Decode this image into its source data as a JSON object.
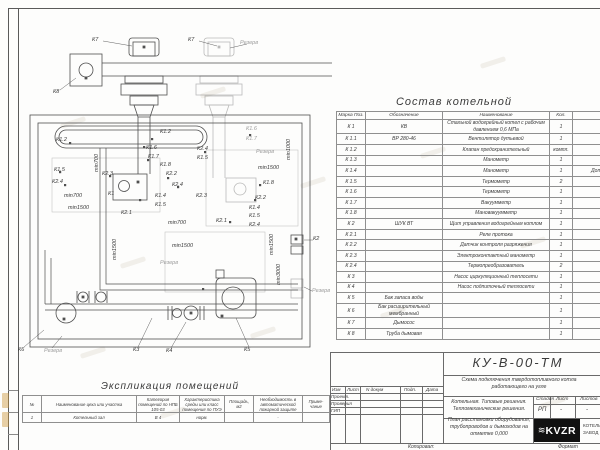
{
  "colors": {
    "line": "#4f4f4f",
    "faded_line": "#b3b3b3",
    "table_line": "#8f8f8f",
    "text": "#3a3a3a",
    "logo_bg": "#111111",
    "logo_text": "#ffffff"
  },
  "diagram": {
    "labels": [
      {
        "t": "К7",
        "x": 92,
        "y": 38
      },
      {
        "t": "К7",
        "x": 188,
        "y": 38
      },
      {
        "t": "Резерв",
        "x": 240,
        "y": 41,
        "f": 1
      },
      {
        "t": "К8",
        "x": 53,
        "y": 90
      },
      {
        "t": "К1.2",
        "x": 56,
        "y": 138
      },
      {
        "t": "К1.2",
        "x": 160,
        "y": 130
      },
      {
        "t": "min700",
        "x": 95,
        "y": 172,
        "r": 1
      },
      {
        "t": "К1.6",
        "x": 146,
        "y": 146
      },
      {
        "t": "К1.7",
        "x": 148,
        "y": 155
      },
      {
        "t": "К1.5",
        "x": 54,
        "y": 168
      },
      {
        "t": "К2.4",
        "x": 52,
        "y": 180
      },
      {
        "t": "К2.3",
        "x": 102,
        "y": 172
      },
      {
        "t": "К1.8",
        "x": 160,
        "y": 163
      },
      {
        "t": "К2.2",
        "x": 166,
        "y": 172
      },
      {
        "t": "К2.4",
        "x": 172,
        "y": 183
      },
      {
        "t": "min700",
        "x": 64,
        "y": 194
      },
      {
        "t": "К1",
        "x": 108,
        "y": 192
      },
      {
        "t": "К1.4",
        "x": 155,
        "y": 194
      },
      {
        "t": "К1.5",
        "x": 155,
        "y": 203
      },
      {
        "t": "min1500",
        "x": 68,
        "y": 206
      },
      {
        "t": "К2.1",
        "x": 121,
        "y": 211
      },
      {
        "t": "К1.6",
        "x": 246,
        "y": 127,
        "f": 1
      },
      {
        "t": "К1.7",
        "x": 246,
        "y": 137,
        "f": 1
      },
      {
        "t": "min1000",
        "x": 287,
        "y": 160,
        "r": 1
      },
      {
        "t": "К2.4",
        "x": 197,
        "y": 147
      },
      {
        "t": "К1.5",
        "x": 197,
        "y": 156
      },
      {
        "t": "Резерв",
        "x": 256,
        "y": 150,
        "f": 1
      },
      {
        "t": "min1500",
        "x": 258,
        "y": 166
      },
      {
        "t": "К1.8",
        "x": 263,
        "y": 181
      },
      {
        "t": "К2.3",
        "x": 196,
        "y": 194
      },
      {
        "t": "К2.2",
        "x": 255,
        "y": 196
      },
      {
        "t": "К1.4",
        "x": 249,
        "y": 206
      },
      {
        "t": "К1.5",
        "x": 249,
        "y": 214
      },
      {
        "t": "К2.1",
        "x": 216,
        "y": 219
      },
      {
        "t": "К2.4",
        "x": 249,
        "y": 223
      },
      {
        "t": "min700",
        "x": 168,
        "y": 221
      },
      {
        "t": "min1500",
        "x": 113,
        "y": 260,
        "r": 1
      },
      {
        "t": "min1500",
        "x": 172,
        "y": 244
      },
      {
        "t": "min1500",
        "x": 270,
        "y": 255,
        "r": 1
      },
      {
        "t": "min3000",
        "x": 277,
        "y": 285,
        "r": 1
      },
      {
        "t": "Резерв",
        "x": 160,
        "y": 261,
        "f": 1
      },
      {
        "t": "К2",
        "x": 313,
        "y": 237
      },
      {
        "t": "Резерв",
        "x": 312,
        "y": 289,
        "f": 1
      },
      {
        "t": "К6",
        "x": 18,
        "y": 348
      },
      {
        "t": "Резерв",
        "x": 44,
        "y": 349,
        "f": 1
      },
      {
        "t": "К3",
        "x": 133,
        "y": 348
      },
      {
        "t": "К4",
        "x": 166,
        "y": 349
      },
      {
        "t": "К5",
        "x": 244,
        "y": 348
      }
    ]
  },
  "sostav": {
    "title": "Состав котельной",
    "headers": [
      "Марка Поз.",
      "Обозначение",
      "Наименование",
      "Кол.",
      "Примечание"
    ],
    "rows": [
      [
        "К 1",
        "КВ",
        "Стальной водогрейный котел с рабочим давлением 0,6 МПа",
        "1",
        ""
      ],
      [
        "К 1.1",
        "ВР 280-46",
        "Вентилятор дутьевой",
        "1",
        ""
      ],
      [
        "К 1.2",
        "",
        "Клапан предохранительный",
        "компл.",
        ""
      ],
      [
        "К 1.3",
        "",
        "Манометр",
        "1",
        ""
      ],
      [
        "К 1.4",
        "",
        "Манометр",
        "1",
        "Допускается зам. поз. К 2.3"
      ],
      [
        "К 1.5",
        "",
        "Термометр",
        "2",
        ""
      ],
      [
        "К 1.6",
        "",
        "Термометр",
        "1",
        "Постав. по согла"
      ],
      [
        "К 1.7",
        "",
        "Вакуумметр",
        "1",
        "Постав. по согла"
      ],
      [
        "К 1.8",
        "",
        "Мановакуумметр",
        "1",
        "Постав. по согла"
      ],
      [
        "К 2",
        "ШУК ВТ",
        "Щит управления водогрейным котлом",
        "1",
        "Постав. по согла"
      ],
      [
        "К 2.1",
        "",
        "Реле протока",
        "1",
        "Постав. с ШУК"
      ],
      [
        "К 2.2",
        "",
        "Датчик контроля разряжения",
        "1",
        "Постав. с ШУК"
      ],
      [
        "К 2.3",
        "",
        "Электроконтактный манометр",
        "1",
        "Постав. с ШУК"
      ],
      [
        "К 2.4",
        "",
        "Термопреобразователь",
        "2",
        "Постав. с ШУК"
      ],
      [
        "К 3",
        "",
        "Насос циркуляционный теплосети",
        "1",
        "Постав. по согла"
      ],
      [
        "К 4",
        "",
        "Насос подпиточный теплосети",
        "1",
        "Постав. по согла"
      ],
      [
        "К 5",
        "Бак запаса воды",
        "",
        "1",
        "Постав. по согла"
      ],
      [
        "К 6",
        "Бак расширительный мембранный",
        "",
        "1",
        "Постав. по согла"
      ],
      [
        "К 7",
        "Дымосос",
        "",
        "1",
        "Постав. по согла"
      ],
      [
        "К 8",
        "Труба дымовая",
        "",
        "1",
        "Постав. по согла"
      ]
    ]
  },
  "explication": {
    "title": "Экспликация помещений",
    "headers": [
      "№",
      "Наименование цеха или участка",
      "Категория помещений по НПБ 105-03",
      "Характеристика среды или класс помещения по ПУЭ",
      "Площадь, м2",
      "Необходимость в автоматической пожарной защите",
      "Приме- чание"
    ],
    "rows": [
      [
        "1",
        "Котельный зал",
        "В 4",
        "норм.",
        "",
        "-",
        ""
      ]
    ]
  },
  "titleblock": {
    "doc_number": "КУ-В-00-ТМ",
    "scheme_title": "Схема подключения твердотопливного котла работающего на угле",
    "project_name": "Котельная. Типовые решения. Тепломеханические решения.",
    "sheet_name": "План расстановки оборудования, трубопроводов и дымоходов на отметке 0,000",
    "stage_label": "Стадия",
    "stage_value": "РП",
    "sheet_label": "Лист",
    "sheet_value": "-",
    "sheets_label": "Листов",
    "sheets_value": "-",
    "rev_headers": [
      "Изм",
      "Лист",
      "N докум",
      "Подп.",
      "Дата"
    ],
    "sig_rows": [
      "Проект.",
      "Проверил",
      "ГИП"
    ],
    "copied_label": "Копировал:",
    "format_label": "Формат",
    "logo_text": "KVZR",
    "logo_side1": "КОТЕЛЬН",
    "logo_side2": "ЗАВОД Р"
  }
}
